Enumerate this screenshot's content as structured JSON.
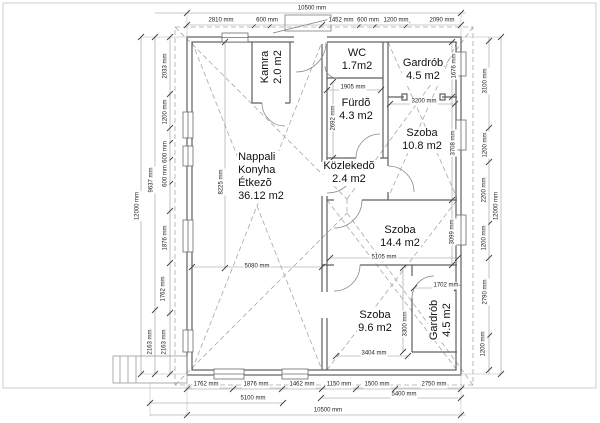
{
  "drawing": {
    "type": "architectural-floor-plan",
    "unit": "mm",
    "room_labels": [
      {
        "lines": [
          "Kamra",
          "2.0 m2"
        ],
        "x": 272,
        "y": 67,
        "rot": -90
      },
      {
        "lines": [
          "WC",
          "1.7m2"
        ],
        "x": 357,
        "y": 60
      },
      {
        "lines": [
          "Gardrób",
          "4.5 m2"
        ],
        "x": 423,
        "y": 70
      },
      {
        "lines": [
          "Fürdõ",
          "4.3 m2"
        ],
        "x": 356,
        "y": 110
      },
      {
        "lines": [
          "Szoba",
          "10.8 m2"
        ],
        "x": 422,
        "y": 140
      },
      {
        "lines": [
          "Nappali",
          "Konyha",
          "Étkezõ",
          "36.12 m2"
        ],
        "x": 261,
        "y": 177,
        "align": "left"
      },
      {
        "lines": [
          "Közlekedõ",
          "2.4 m2"
        ],
        "x": 349,
        "y": 173
      },
      {
        "lines": [
          "Szoba",
          "14.4 m2"
        ],
        "x": 400,
        "y": 237
      },
      {
        "lines": [
          "Szoba",
          "9.6 m2"
        ],
        "x": 375,
        "y": 322
      },
      {
        "lines": [
          "Gardrób",
          "4.5 m2"
        ],
        "x": 441,
        "y": 320,
        "rot": -90
      }
    ],
    "dim_labels": [
      {
        "t": "10500 mm",
        "x": 312,
        "y": 9
      },
      {
        "t": "2810 mm",
        "x": 221,
        "y": 21
      },
      {
        "t": "600 mm",
        "x": 267,
        "y": 21
      },
      {
        "t": "1452 mm",
        "x": 341,
        "y": 21
      },
      {
        "t": "600 mm",
        "x": 368,
        "y": 21
      },
      {
        "t": "1200 mm",
        "x": 396,
        "y": 21
      },
      {
        "t": "2090 mm",
        "x": 442,
        "y": 21
      },
      {
        "t": "12000 mm",
        "x": 138,
        "y": 206,
        "r": -90
      },
      {
        "t": "9637 mm",
        "x": 152,
        "y": 180,
        "r": -90
      },
      {
        "t": "2033 mm",
        "x": 166,
        "y": 66,
        "r": -90
      },
      {
        "t": "1200 mm",
        "x": 166,
        "y": 112,
        "r": -90
      },
      {
        "t": "600 mm",
        "x": 166,
        "y": 152,
        "r": -90
      },
      {
        "t": "600 mm",
        "x": 166,
        "y": 176,
        "r": -90
      },
      {
        "t": "1876 mm",
        "x": 166,
        "y": 238,
        "r": -90
      },
      {
        "t": "1762 mm",
        "x": 164,
        "y": 289,
        "r": -90
      },
      {
        "t": "2163 mm",
        "x": 151,
        "y": 342,
        "r": -90
      },
      {
        "t": "2163 mm",
        "x": 165,
        "y": 342,
        "r": -90
      },
      {
        "t": "3100 mm",
        "x": 486,
        "y": 81,
        "r": -90
      },
      {
        "t": "1200 mm",
        "x": 486,
        "y": 145,
        "r": -90
      },
      {
        "t": "2200 mm",
        "x": 485,
        "y": 190,
        "r": -90
      },
      {
        "t": "1200 mm",
        "x": 485,
        "y": 238,
        "r": -90
      },
      {
        "t": "2790 mm",
        "x": 486,
        "y": 292,
        "r": -90
      },
      {
        "t": "1200 mm",
        "x": 484,
        "y": 344,
        "r": -90
      },
      {
        "t": "12000 mm",
        "x": 497,
        "y": 206,
        "r": -90
      },
      {
        "t": "1676 mm",
        "x": 455,
        "y": 66,
        "r": -90
      },
      {
        "t": "3708 mm",
        "x": 454,
        "y": 143,
        "r": -90
      },
      {
        "t": "3099 mm",
        "x": 453,
        "y": 232,
        "r": -90
      },
      {
        "t": "1905 mm",
        "x": 353,
        "y": 88
      },
      {
        "t": "2692 mm",
        "x": 334,
        "y": 118,
        "r": -90
      },
      {
        "t": "3200 mm",
        "x": 424,
        "y": 102
      },
      {
        "t": "8225 mm",
        "x": 222,
        "y": 182,
        "r": -90
      },
      {
        "t": "5080 mm",
        "x": 257,
        "y": 267
      },
      {
        "t": "5105 mm",
        "x": 384,
        "y": 258
      },
      {
        "t": "1702 mm",
        "x": 446,
        "y": 286
      },
      {
        "t": "3404 mm",
        "x": 374,
        "y": 354
      },
      {
        "t": "3300 mm",
        "x": 406,
        "y": 324,
        "r": -90
      },
      {
        "t": "1762 mm",
        "x": 206,
        "y": 385
      },
      {
        "t": "1876 mm",
        "x": 256,
        "y": 385
      },
      {
        "t": "1462 mm",
        "x": 302,
        "y": 385
      },
      {
        "t": "1150 mm",
        "x": 339,
        "y": 385
      },
      {
        "t": "1500 mm",
        "x": 377,
        "y": 385
      },
      {
        "t": "2750 mm",
        "x": 434,
        "y": 385
      },
      {
        "t": "5400 mm",
        "x": 404,
        "y": 395
      },
      {
        "t": "5100 mm",
        "x": 253,
        "y": 399
      },
      {
        "t": "10500 mm",
        "x": 328,
        "y": 411
      }
    ]
  }
}
